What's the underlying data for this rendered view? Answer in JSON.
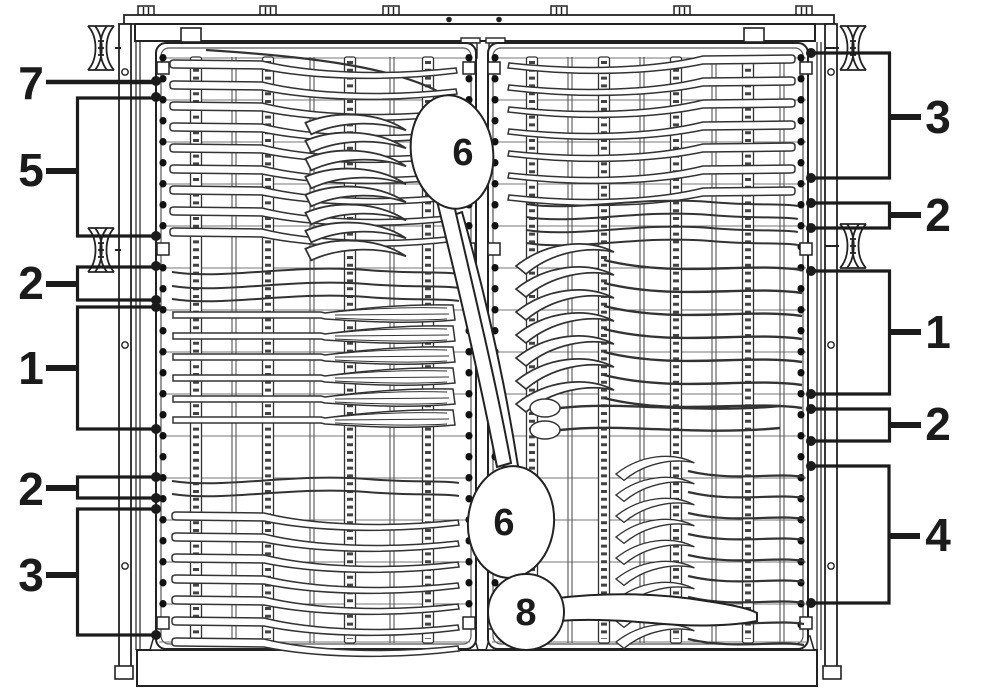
{
  "callouts": {
    "left": [
      {
        "label": "7"
      },
      {
        "label": "5"
      },
      {
        "label": "2"
      },
      {
        "label": "1"
      },
      {
        "label": "2"
      },
      {
        "label": "3"
      }
    ],
    "right": [
      {
        "label": "3"
      },
      {
        "label": "2"
      },
      {
        "label": "1"
      },
      {
        "label": "2"
      },
      {
        "label": "4"
      }
    ],
    "center": [
      {
        "label": "6"
      },
      {
        "label": "6"
      },
      {
        "label": "8"
      }
    ]
  },
  "colors": {
    "ink": "#1f1f1f",
    "paper": "#ffffff"
  }
}
